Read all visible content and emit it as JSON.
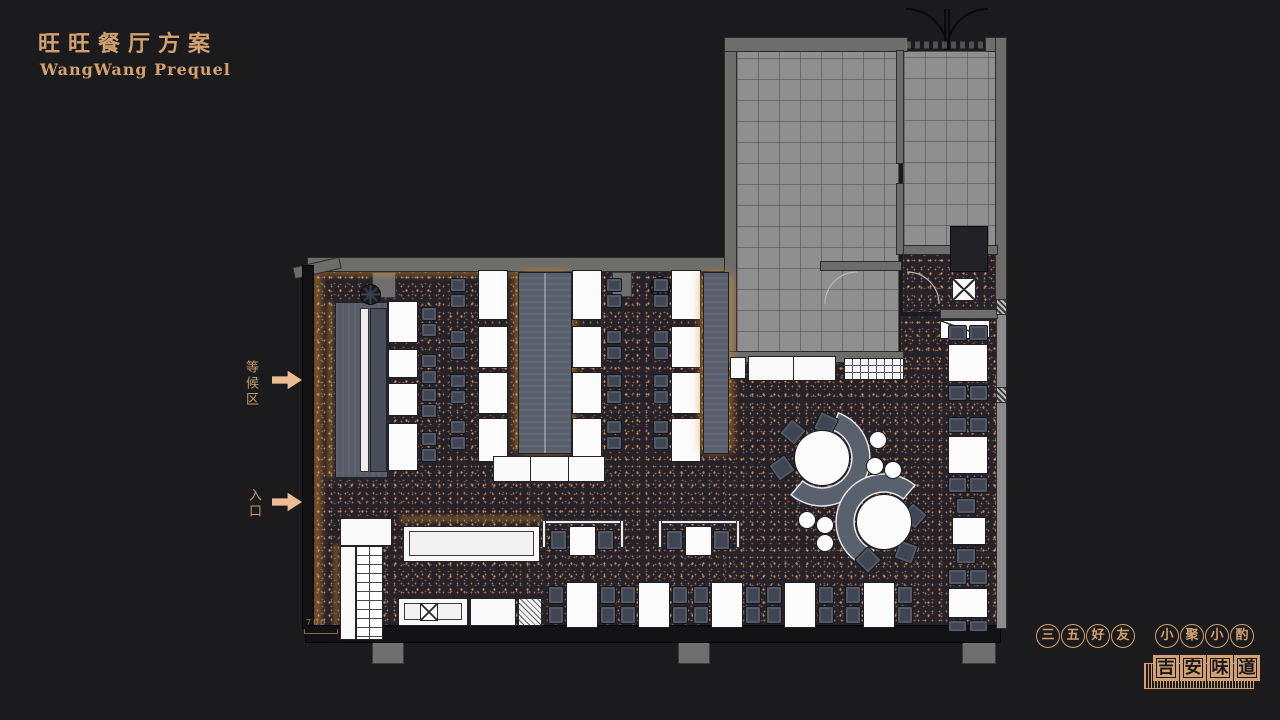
{
  "colors": {
    "background": "#1b1b1d",
    "accent_gold": "#d3a06e",
    "arrow": "#ecbd92",
    "floor_dark": "#26222a",
    "kitchen_gray": "#8f8f8f",
    "banquette_slate": "#59606d",
    "table_white": "#fbfbfb",
    "chair_slate": "#3f4552"
  },
  "header": {
    "title": "旺旺餐厅方案",
    "subtitle": "WangWang Prequel"
  },
  "annotations": {
    "waiting_area": "等候区",
    "entrance": "入口",
    "dimension": "700"
  },
  "footer": {
    "circle_phrase_1": [
      "三",
      "五",
      "好",
      "友"
    ],
    "circle_phrase_2": [
      "小",
      "聚",
      "小",
      "酌"
    ],
    "seal": [
      "吉",
      "安",
      "味",
      "道"
    ]
  },
  "plan": {
    "furniture": [
      {
        "t": "platform",
        "x": 35,
        "y": 282,
        "w": 53,
        "h": 176
      },
      {
        "t": "bar",
        "x": 60,
        "y": 288,
        "w": 9,
        "h": 164
      },
      {
        "t": "bench",
        "x": 70,
        "y": 288,
        "w": 17,
        "h": 164
      },
      {
        "t": "pier",
        "x": 72,
        "y": 252,
        "w": 24,
        "h": 26
      },
      {
        "t": "pier",
        "x": 312,
        "y": 252,
        "w": 20,
        "h": 25
      },
      {
        "t": "fan",
        "x": 60,
        "y": 264,
        "w": 21,
        "h": 21
      },
      {
        "t": "fan",
        "x": 350,
        "y": 257,
        "w": 21,
        "h": 21
      },
      {
        "t": "table",
        "x": 88,
        "y": 281,
        "w": 30,
        "h": 42
      },
      {
        "t": "table",
        "x": 88,
        "y": 329,
        "w": 30,
        "h": 29
      },
      {
        "t": "table",
        "x": 88,
        "y": 363,
        "w": 30,
        "h": 33
      },
      {
        "t": "table",
        "x": 88,
        "y": 403,
        "w": 30,
        "h": 48
      },
      {
        "t": "chair",
        "x": 121,
        "y": 287,
        "w": 16,
        "h": 14
      },
      {
        "t": "chair",
        "x": 121,
        "y": 303,
        "w": 16,
        "h": 14
      },
      {
        "t": "chair",
        "x": 121,
        "y": 334,
        "w": 16,
        "h": 14
      },
      {
        "t": "chair",
        "x": 121,
        "y": 350,
        "w": 16,
        "h": 14
      },
      {
        "t": "chair",
        "x": 121,
        "y": 368,
        "w": 16,
        "h": 14
      },
      {
        "t": "chair",
        "x": 121,
        "y": 384,
        "w": 16,
        "h": 14
      },
      {
        "t": "chair",
        "x": 121,
        "y": 412,
        "w": 16,
        "h": 14
      },
      {
        "t": "chair",
        "x": 121,
        "y": 428,
        "w": 16,
        "h": 14
      },
      {
        "t": "chair",
        "x": 150,
        "y": 258,
        "w": 16,
        "h": 14
      },
      {
        "t": "chair",
        "x": 150,
        "y": 274,
        "w": 16,
        "h": 14
      },
      {
        "t": "chair",
        "x": 150,
        "y": 310,
        "w": 16,
        "h": 14
      },
      {
        "t": "chair",
        "x": 150,
        "y": 326,
        "w": 16,
        "h": 14
      },
      {
        "t": "chair",
        "x": 150,
        "y": 354,
        "w": 16,
        "h": 14
      },
      {
        "t": "chair",
        "x": 150,
        "y": 370,
        "w": 16,
        "h": 14
      },
      {
        "t": "chair",
        "x": 150,
        "y": 400,
        "w": 16,
        "h": 14
      },
      {
        "t": "chair",
        "x": 150,
        "y": 416,
        "w": 16,
        "h": 14
      },
      {
        "t": "table",
        "x": 178,
        "y": 250,
        "w": 30,
        "h": 50
      },
      {
        "t": "table",
        "x": 178,
        "y": 306,
        "w": 30,
        "h": 42
      },
      {
        "t": "table",
        "x": 178,
        "y": 352,
        "w": 30,
        "h": 42
      },
      {
        "t": "table",
        "x": 178,
        "y": 398,
        "w": 30,
        "h": 44
      },
      {
        "t": "booth",
        "cls": "split",
        "x": 218,
        "y": 252,
        "w": 54,
        "h": 182
      },
      {
        "t": "table",
        "x": 272,
        "y": 250,
        "w": 30,
        "h": 50
      },
      {
        "t": "table",
        "x": 272,
        "y": 306,
        "w": 30,
        "h": 42
      },
      {
        "t": "table",
        "x": 272,
        "y": 352,
        "w": 30,
        "h": 42
      },
      {
        "t": "table",
        "x": 272,
        "y": 398,
        "w": 30,
        "h": 44
      },
      {
        "t": "chair",
        "x": 306,
        "y": 258,
        "w": 16,
        "h": 14
      },
      {
        "t": "chair",
        "x": 306,
        "y": 274,
        "w": 16,
        "h": 14
      },
      {
        "t": "chair",
        "x": 306,
        "y": 310,
        "w": 16,
        "h": 14
      },
      {
        "t": "chair",
        "x": 306,
        "y": 326,
        "w": 16,
        "h": 14
      },
      {
        "t": "chair",
        "x": 306,
        "y": 354,
        "w": 16,
        "h": 14
      },
      {
        "t": "chair",
        "x": 306,
        "y": 370,
        "w": 16,
        "h": 14
      },
      {
        "t": "chair",
        "x": 306,
        "y": 400,
        "w": 16,
        "h": 14
      },
      {
        "t": "chair",
        "x": 306,
        "y": 416,
        "w": 16,
        "h": 14
      },
      {
        "t": "counter",
        "cls": "seg3",
        "x": 193,
        "y": 436,
        "w": 112,
        "h": 26
      },
      {
        "t": "chair",
        "x": 353,
        "y": 258,
        "w": 16,
        "h": 14
      },
      {
        "t": "chair",
        "x": 353,
        "y": 274,
        "w": 16,
        "h": 14
      },
      {
        "t": "chair",
        "x": 353,
        "y": 310,
        "w": 16,
        "h": 14
      },
      {
        "t": "chair",
        "x": 353,
        "y": 326,
        "w": 16,
        "h": 14
      },
      {
        "t": "chair",
        "x": 353,
        "y": 354,
        "w": 16,
        "h": 14
      },
      {
        "t": "chair",
        "x": 353,
        "y": 370,
        "w": 16,
        "h": 14
      },
      {
        "t": "chair",
        "x": 353,
        "y": 400,
        "w": 16,
        "h": 14
      },
      {
        "t": "chair",
        "x": 353,
        "y": 416,
        "w": 16,
        "h": 14
      },
      {
        "t": "table",
        "x": 371,
        "y": 250,
        "w": 30,
        "h": 50
      },
      {
        "t": "table",
        "x": 371,
        "y": 306,
        "w": 30,
        "h": 42
      },
      {
        "t": "table",
        "x": 371,
        "y": 352,
        "w": 30,
        "h": 42
      },
      {
        "t": "table",
        "x": 371,
        "y": 398,
        "w": 30,
        "h": 44
      },
      {
        "t": "booth",
        "x": 403,
        "y": 252,
        "w": 26,
        "h": 182
      },
      {
        "t": "counter",
        "x": 430,
        "y": 337,
        "w": 16,
        "h": 22
      },
      {
        "t": "counter",
        "cls": "seg2",
        "x": 448,
        "y": 336,
        "w": 88,
        "h": 25
      },
      {
        "t": "gridbox",
        "x": 544,
        "y": 338,
        "w": 60,
        "h": 22
      },
      {
        "t": "xbox",
        "x": 652,
        "y": 258,
        "w": 24,
        "h": 23
      },
      {
        "t": "diagbox",
        "x": 640,
        "y": 300,
        "w": 50,
        "h": 19
      },
      {
        "t": "block",
        "x": 650,
        "y": 206,
        "w": 38,
        "h": 46
      },
      {
        "t": "chair",
        "x": 648,
        "y": 305,
        "w": 19,
        "h": 16
      },
      {
        "t": "chair",
        "x": 669,
        "y": 305,
        "w": 19,
        "h": 16
      },
      {
        "t": "table",
        "x": 648,
        "y": 324,
        "w": 40,
        "h": 38
      },
      {
        "t": "chair",
        "x": 648,
        "y": 365,
        "w": 19,
        "h": 16
      },
      {
        "t": "chair",
        "x": 669,
        "y": 365,
        "w": 19,
        "h": 16
      },
      {
        "t": "chair",
        "x": 648,
        "y": 397,
        "w": 19,
        "h": 16
      },
      {
        "t": "chair",
        "x": 669,
        "y": 397,
        "w": 19,
        "h": 16
      },
      {
        "t": "table",
        "x": 648,
        "y": 416,
        "w": 40,
        "h": 38
      },
      {
        "t": "chair",
        "x": 648,
        "y": 457,
        "w": 19,
        "h": 16
      },
      {
        "t": "chair",
        "x": 669,
        "y": 457,
        "w": 19,
        "h": 16
      },
      {
        "t": "chair",
        "x": 656,
        "y": 478,
        "w": 20,
        "h": 16
      },
      {
        "t": "table",
        "x": 652,
        "y": 497,
        "w": 34,
        "h": 28
      },
      {
        "t": "chair",
        "x": 656,
        "y": 528,
        "w": 20,
        "h": 16
      },
      {
        "t": "chair",
        "x": 648,
        "y": 549,
        "w": 19,
        "h": 16
      },
      {
        "t": "chair",
        "x": 669,
        "y": 549,
        "w": 19,
        "h": 16
      },
      {
        "t": "table",
        "x": 648,
        "y": 568,
        "w": 40,
        "h": 30
      },
      {
        "t": "chair",
        "x": 648,
        "y": 600,
        "w": 19,
        "h": 12
      },
      {
        "t": "chair",
        "x": 669,
        "y": 600,
        "w": 19,
        "h": 12
      },
      {
        "t": "chair",
        "x": 248,
        "y": 566,
        "w": 16,
        "h": 18
      },
      {
        "t": "chair",
        "x": 248,
        "y": 586,
        "w": 16,
        "h": 18
      },
      {
        "t": "table",
        "x": 266,
        "y": 562,
        "w": 32,
        "h": 46
      },
      {
        "t": "chair",
        "x": 300,
        "y": 566,
        "w": 16,
        "h": 18
      },
      {
        "t": "chair",
        "x": 300,
        "y": 586,
        "w": 16,
        "h": 18
      },
      {
        "t": "chair",
        "x": 320,
        "y": 566,
        "w": 16,
        "h": 18
      },
      {
        "t": "chair",
        "x": 320,
        "y": 586,
        "w": 16,
        "h": 18
      },
      {
        "t": "table",
        "x": 338,
        "y": 562,
        "w": 32,
        "h": 46
      },
      {
        "t": "chair",
        "x": 372,
        "y": 566,
        "w": 16,
        "h": 18
      },
      {
        "t": "chair",
        "x": 372,
        "y": 586,
        "w": 16,
        "h": 18
      },
      {
        "t": "chair",
        "x": 393,
        "y": 566,
        "w": 16,
        "h": 18
      },
      {
        "t": "chair",
        "x": 393,
        "y": 586,
        "w": 16,
        "h": 18
      },
      {
        "t": "table",
        "x": 411,
        "y": 562,
        "w": 32,
        "h": 46
      },
      {
        "t": "chair",
        "x": 445,
        "y": 566,
        "w": 16,
        "h": 18
      },
      {
        "t": "chair",
        "x": 445,
        "y": 586,
        "w": 16,
        "h": 18
      },
      {
        "t": "chair",
        "x": 466,
        "y": 566,
        "w": 16,
        "h": 18
      },
      {
        "t": "chair",
        "x": 466,
        "y": 586,
        "w": 16,
        "h": 18
      },
      {
        "t": "table",
        "x": 484,
        "y": 562,
        "w": 32,
        "h": 46
      },
      {
        "t": "chair",
        "x": 518,
        "y": 566,
        "w": 16,
        "h": 18
      },
      {
        "t": "chair",
        "x": 518,
        "y": 586,
        "w": 16,
        "h": 18
      },
      {
        "t": "chair",
        "x": 545,
        "y": 566,
        "w": 16,
        "h": 18
      },
      {
        "t": "chair",
        "x": 545,
        "y": 586,
        "w": 16,
        "h": 18
      },
      {
        "t": "table",
        "x": 563,
        "y": 562,
        "w": 32,
        "h": 46
      },
      {
        "t": "chair",
        "x": 597,
        "y": 566,
        "w": 16,
        "h": 18
      },
      {
        "t": "chair",
        "x": 597,
        "y": 586,
        "w": 16,
        "h": 18
      },
      {
        "t": "bar",
        "x": 242,
        "y": 500,
        "w": 82,
        "h": 4
      },
      {
        "t": "bar",
        "x": 242,
        "y": 500,
        "w": 4,
        "h": 28
      },
      {
        "t": "bar",
        "x": 320,
        "y": 500,
        "w": 4,
        "h": 28
      },
      {
        "t": "chair",
        "x": 250,
        "y": 510,
        "w": 17,
        "h": 20
      },
      {
        "t": "table",
        "x": 269,
        "y": 506,
        "w": 27,
        "h": 30
      },
      {
        "t": "chair",
        "x": 297,
        "y": 510,
        "w": 17,
        "h": 20
      },
      {
        "t": "bar",
        "x": 358,
        "y": 500,
        "w": 82,
        "h": 4
      },
      {
        "t": "bar",
        "x": 358,
        "y": 500,
        "w": 4,
        "h": 28
      },
      {
        "t": "bar",
        "x": 436,
        "y": 500,
        "w": 4,
        "h": 28
      },
      {
        "t": "chair",
        "x": 366,
        "y": 510,
        "w": 17,
        "h": 20
      },
      {
        "t": "table",
        "x": 385,
        "y": 506,
        "w": 27,
        "h": 30
      },
      {
        "t": "chair",
        "x": 413,
        "y": 510,
        "w": 17,
        "h": 20
      },
      {
        "t": "counter",
        "x": 40,
        "y": 498,
        "w": 52,
        "h": 28
      },
      {
        "t": "counter",
        "x": 40,
        "y": 526,
        "w": 16,
        "h": 94
      },
      {
        "t": "ladder",
        "x": 56,
        "y": 526,
        "w": 27,
        "h": 94
      },
      {
        "t": "counter",
        "cls": "inner",
        "x": 103,
        "y": 506,
        "w": 137,
        "h": 36
      },
      {
        "t": "counter",
        "cls": "inner",
        "x": 98,
        "y": 578,
        "w": 70,
        "h": 28
      },
      {
        "t": "xbox",
        "x": 120,
        "y": 583,
        "w": 18,
        "h": 18
      },
      {
        "t": "counter",
        "x": 170,
        "y": 578,
        "w": 46,
        "h": 28
      },
      {
        "t": "hatchbox",
        "x": 218,
        "y": 578,
        "w": 24,
        "h": 28
      },
      {
        "t": "rtable",
        "x": 494,
        "y": 410,
        "w": 56,
        "h": 56
      },
      {
        "t": "rtable",
        "x": 556,
        "y": 474,
        "w": 56,
        "h": 56
      },
      {
        "t": "chair",
        "x": 483,
        "y": 402,
        "w": 20,
        "h": 20,
        "rot": 40
      },
      {
        "t": "chair",
        "x": 516,
        "y": 394,
        "w": 20,
        "h": 20,
        "rot": 25
      },
      {
        "t": "chair",
        "x": 472,
        "y": 438,
        "w": 20,
        "h": 20,
        "rot": 55
      },
      {
        "t": "chair",
        "x": 604,
        "y": 486,
        "w": 20,
        "h": 20,
        "rot": 40
      },
      {
        "t": "chair",
        "x": 596,
        "y": 522,
        "w": 20,
        "h": 20,
        "rot": 20
      },
      {
        "t": "chair",
        "x": 558,
        "y": 530,
        "w": 20,
        "h": 20,
        "rot": 45
      },
      {
        "t": "stool",
        "x": 569,
        "y": 411,
        "w": 18,
        "h": 18
      },
      {
        "t": "stool",
        "x": 566,
        "y": 437,
        "w": 18,
        "h": 18
      },
      {
        "t": "stool",
        "x": 584,
        "y": 441,
        "w": 18,
        "h": 18
      },
      {
        "t": "stool",
        "x": 498,
        "y": 491,
        "w": 18,
        "h": 18
      },
      {
        "t": "stool",
        "x": 516,
        "y": 496,
        "w": 18,
        "h": 18
      },
      {
        "t": "stool",
        "x": 516,
        "y": 514,
        "w": 18,
        "h": 18
      },
      {
        "t": "pier",
        "x": 72,
        "y": 616,
        "w": 32,
        "h": 28
      },
      {
        "t": "pier",
        "x": 378,
        "y": 616,
        "w": 32,
        "h": 28
      },
      {
        "t": "pier",
        "x": 662,
        "y": 616,
        "w": 34,
        "h": 28
      }
    ]
  }
}
